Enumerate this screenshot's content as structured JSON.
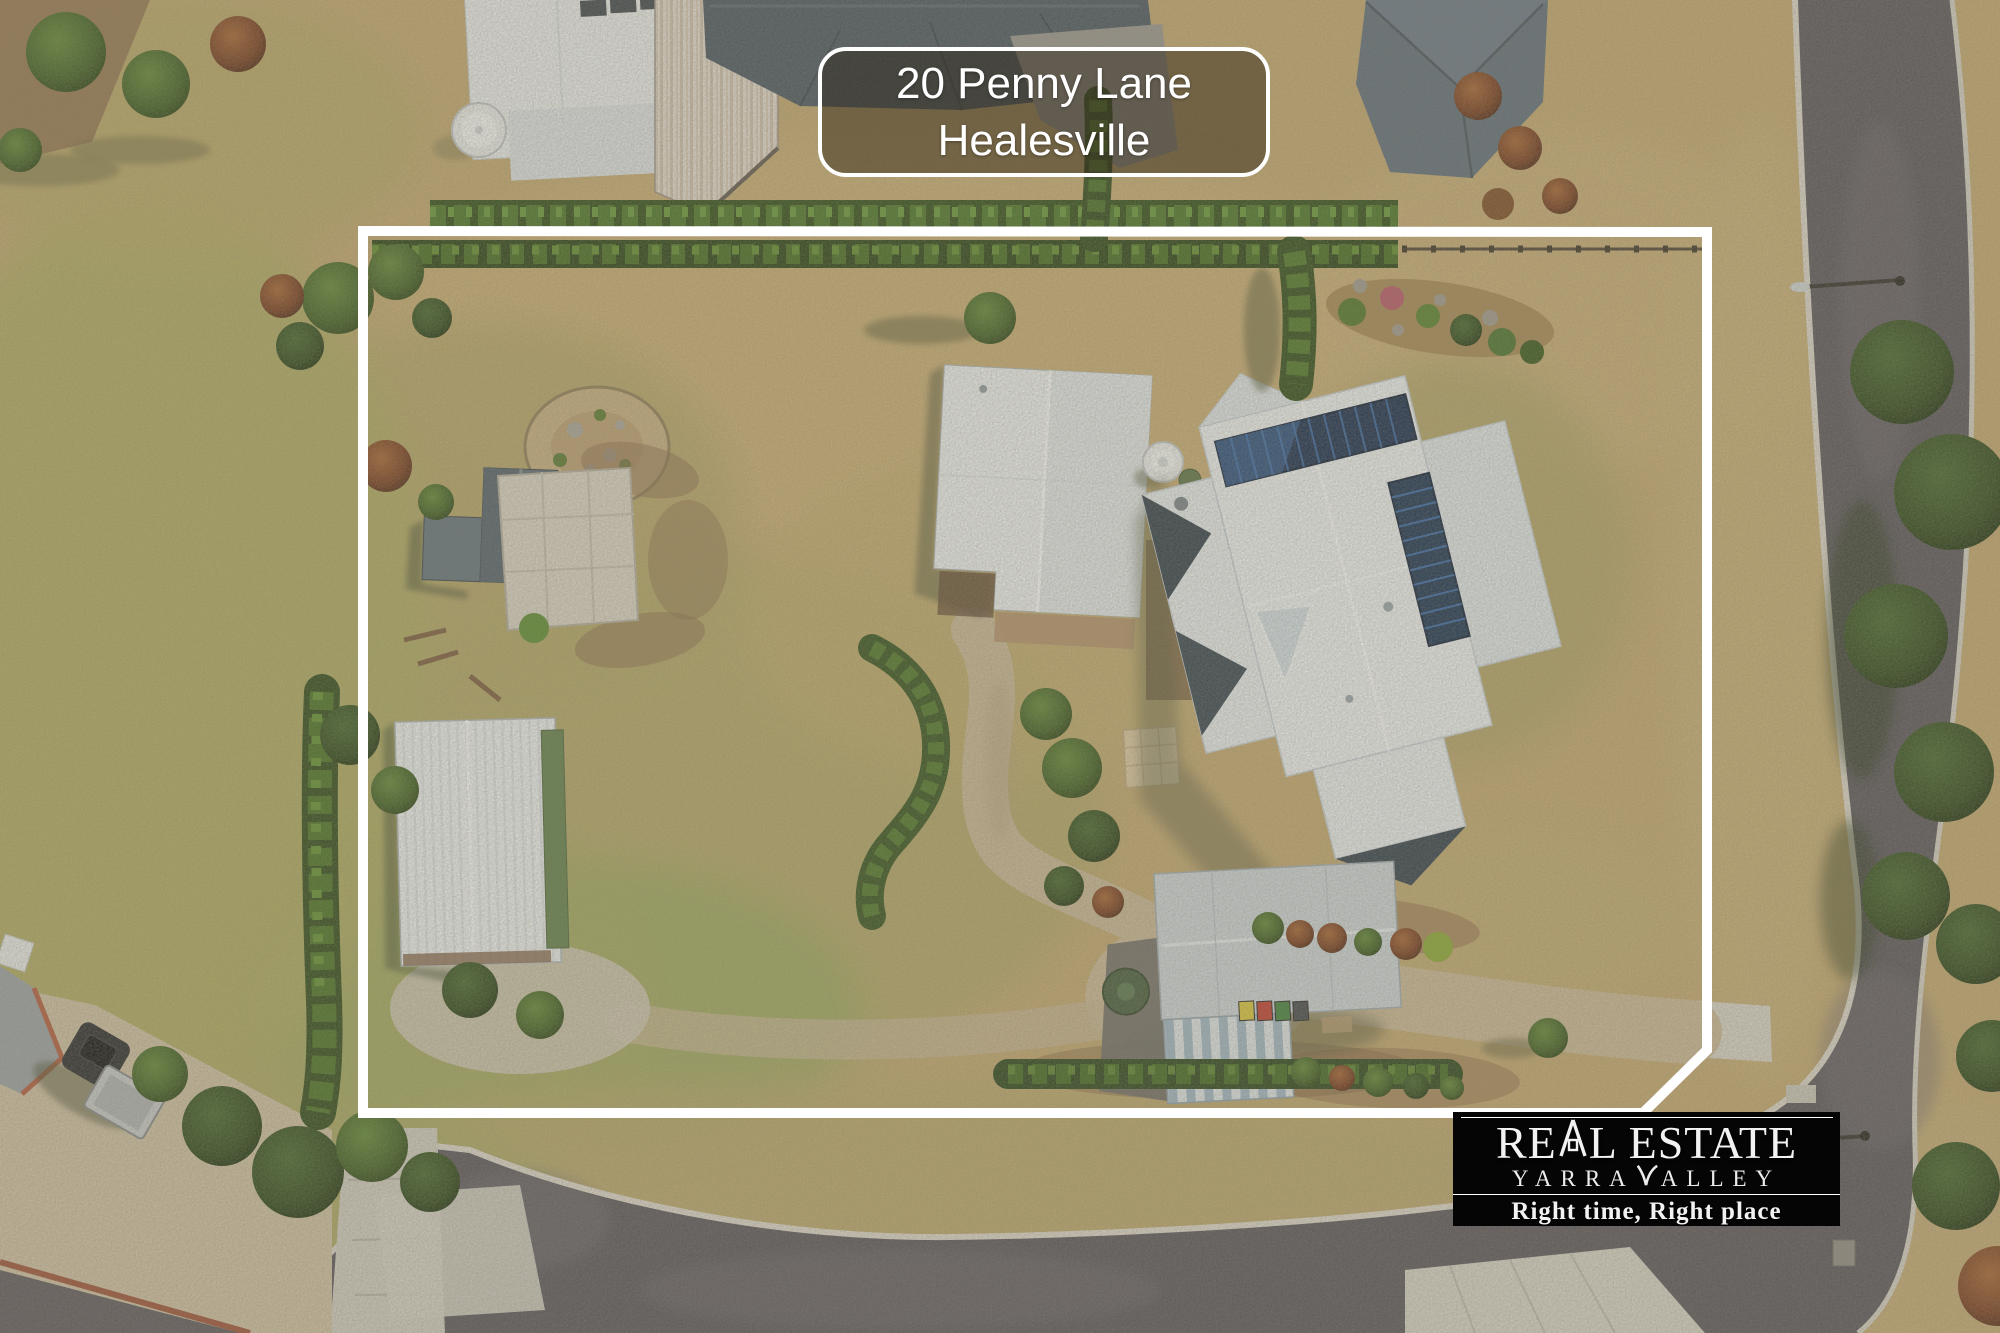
{
  "address_label": {
    "line1": "20 Penny Lane",
    "line2": "Healesville"
  },
  "logo": {
    "brand_re": "RE",
    "brand_l_estate": "L ESTATE",
    "sub_yarra": "YARRA",
    "sub_alley": "ALLEY",
    "tagline": "Right time, Right place",
    "background_color": "#050505",
    "text_color": "#f2f2f2"
  },
  "scene": {
    "kind": "aerial-drone-photo",
    "subject": "rural residential property with white lot boundary outline",
    "boundary_color": "#ffffff",
    "palette": {
      "dry_grass": "#c3a76f",
      "green_grass": "#9aa85e",
      "hedge": "#42691f",
      "road_asphalt": "#56525a",
      "concrete": "#d6d2c7",
      "gravel_drive": "#cab795",
      "roof_white": "#eef1f4",
      "roof_dark_blue": "#46535f",
      "roof_grey": "#5c6b79",
      "solar_panel": "#152a4d"
    },
    "features": [
      "main-house-white-roof-with-solar-panels",
      "detached-garage-white-gable",
      "grey-garden-shed",
      "large-white-shed",
      "machinery-shed-with-bins",
      "water-tank",
      "gravel-driveway",
      "boxed-hedges",
      "street-right",
      "street-bottom",
      "neighbour-houses-top",
      "ute-parked-bottom-left",
      "rock-garden"
    ]
  }
}
